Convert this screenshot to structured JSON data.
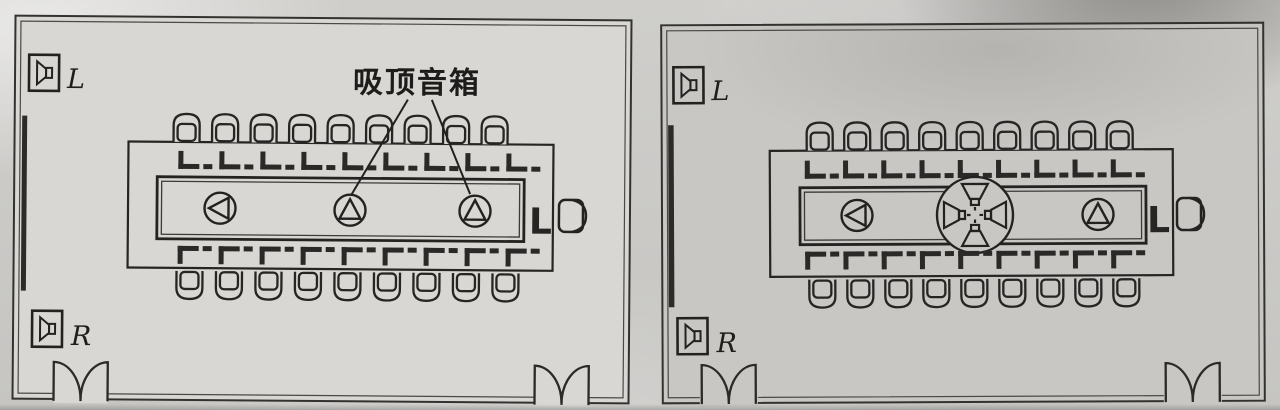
{
  "figure": {
    "annotation": "吸顶音箱",
    "left_room": {
      "wall_speaker_top_label": "L",
      "wall_speaker_bottom_label": "R",
      "head_seat_label": "L",
      "ceiling_speakers": [
        "mono-speaker-left-facing",
        "mono-speaker-up-facing",
        "mono-speaker-up-facing"
      ]
    },
    "right_room": {
      "wall_speaker_top_label": "L",
      "wall_speaker_bottom_label": "R",
      "head_seat_label": "L",
      "ceiling_speakers": [
        "mono-speaker-left-facing",
        "four-horn-cluster",
        "mono-speaker-up-facing"
      ]
    }
  },
  "icons": {
    "wall_speaker": "boxed-horn-speaker-icon",
    "ceiling_speaker": "circle-with-inscribed-triangle",
    "ceiling_speaker_cluster": "circle-with-four-outward-horns",
    "chair": "round-back-chair-top-view",
    "table_bracket": "l-shaped-seat-bracket",
    "door": "double-swing-door-arcs",
    "window_strip": "thick-wall-bar"
  },
  "colors": {
    "line": "#262524",
    "paper_left_room": "#d8d7d3",
    "paper_right_room": "#c8c7c4",
    "page_background": "#cbcac7"
  }
}
